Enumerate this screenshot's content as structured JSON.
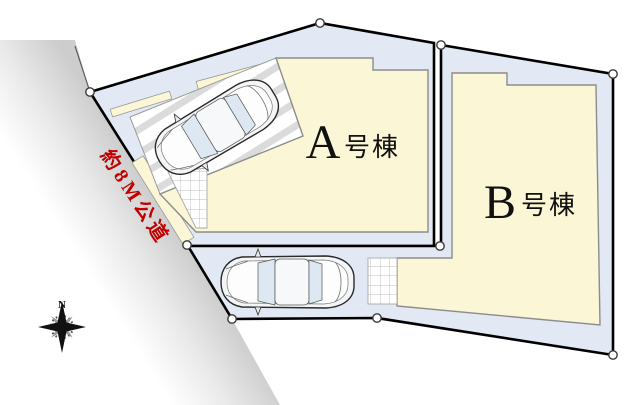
{
  "site_plan": {
    "parcels": [
      {
        "id": "A",
        "letter": "A",
        "suffix": "号棟",
        "label": "A号棟"
      },
      {
        "id": "B",
        "letter": "B",
        "suffix": "号棟",
        "label": "B号棟"
      }
    ],
    "road": {
      "label": "約8M公道"
    },
    "compass": {
      "north_label": "N"
    }
  },
  "colors": {
    "parcel_fill": "#e3e9f4",
    "building_fill": "#fbf6d5",
    "building_stroke": "#8c8c8c",
    "boundary": "#000000",
    "road_label_red": "#c00000",
    "road_gray": "#cccccc",
    "glass": "#dde8f2",
    "hatch_stripe": "#dbdbdb"
  }
}
